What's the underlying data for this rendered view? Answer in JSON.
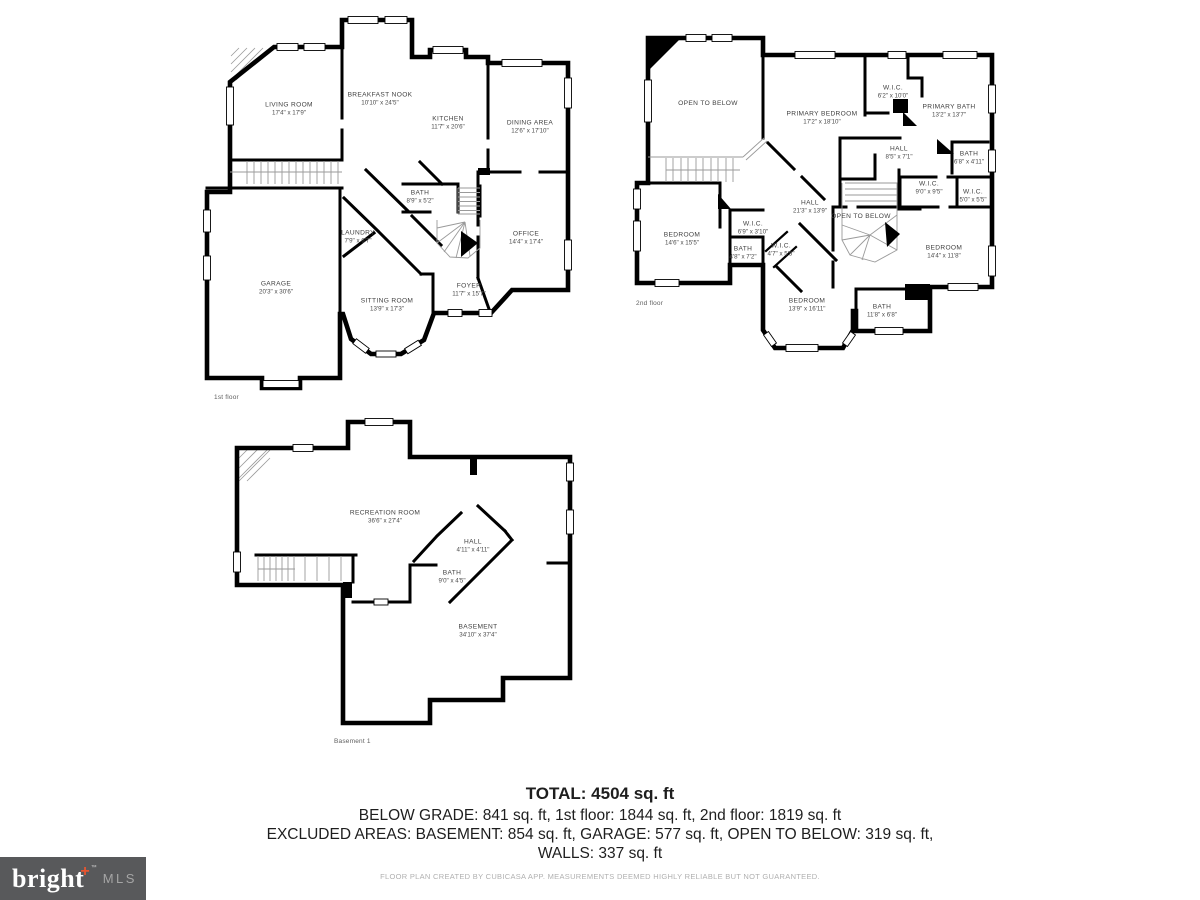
{
  "floors": {
    "first": {
      "caption": "1st floor",
      "rooms": [
        {
          "name": "LIVING ROOM",
          "dims": "17'4\" x 17'9\""
        },
        {
          "name": "BREAKFAST NOOK",
          "dims": "10'10\" x 24'5\""
        },
        {
          "name": "KITCHEN",
          "dims": "11'7\" x 20'6\""
        },
        {
          "name": "DINING AREA",
          "dims": "12'6\" x 17'10\""
        },
        {
          "name": "BATH",
          "dims": "8'9\" x 5'2\""
        },
        {
          "name": "OFFICE",
          "dims": "14'4\" x 17'4\""
        },
        {
          "name": "LAUNDRY",
          "dims": "7'9\" x 6'7\""
        },
        {
          "name": "GARAGE",
          "dims": "20'3\" x 30'6\""
        },
        {
          "name": "SITTING ROOM",
          "dims": "13'9\" x 17'3\""
        },
        {
          "name": "FOYER",
          "dims": "11'7\" x 15'7\""
        }
      ]
    },
    "second": {
      "caption": "2nd floor",
      "rooms": [
        {
          "name": "OPEN TO BELOW",
          "dims": ""
        },
        {
          "name": "PRIMARY BEDROOM",
          "dims": "17'2\" x 18'10\""
        },
        {
          "name": "W.I.C.",
          "dims": "6'2\" x 10'0\""
        },
        {
          "name": "PRIMARY BATH",
          "dims": "13'2\" x 13'7\""
        },
        {
          "name": "HALL",
          "dims": "8'5\" x 7'1\""
        },
        {
          "name": "BATH",
          "dims": "6'8\" x 4'11\""
        },
        {
          "name": "W.I.C.",
          "dims": "9'0\" x 9'5\""
        },
        {
          "name": "W.I.C.",
          "dims": "5'0\" x 5'5\""
        },
        {
          "name": "HALL",
          "dims": "21'3\" x 13'9\""
        },
        {
          "name": "OPEN TO BELOW",
          "dims": ""
        },
        {
          "name": "BEDROOM",
          "dims": "14'6\" x 15'5\""
        },
        {
          "name": "W.I.C.",
          "dims": "6'9\" x 3'10\""
        },
        {
          "name": "BATH",
          "dims": "4'8\" x 7'2\""
        },
        {
          "name": "W.I.C.",
          "dims": "4'7\" x 5'5\""
        },
        {
          "name": "BEDROOM",
          "dims": "14'4\" x 11'8\""
        },
        {
          "name": "BEDROOM",
          "dims": "13'9\" x 16'11\""
        },
        {
          "name": "BATH",
          "dims": "11'8\" x 6'8\""
        }
      ]
    },
    "basement": {
      "caption": "Basement 1",
      "rooms": [
        {
          "name": "RECREATION ROOM",
          "dims": "36'6\" x 27'4\""
        },
        {
          "name": "HALL",
          "dims": "4'11\" x 4'11\""
        },
        {
          "name": "BATH",
          "dims": "9'0\" x 4'5\""
        },
        {
          "name": "BASEMENT",
          "dims": "34'10\" x 37'4\""
        }
      ]
    }
  },
  "summary": {
    "total": "TOTAL: 4504 sq. ft",
    "line2": "BELOW GRADE: 841 sq. ft, 1st floor: 1844 sq. ft, 2nd floor: 1819 sq. ft",
    "line3": "EXCLUDED AREAS: BASEMENT: 854 sq. ft, GARAGE: 577 sq. ft, OPEN TO BELOW: 319 sq. ft,",
    "line4": "WALLS: 337 sq. ft",
    "disclaimer": "FLOOR PLAN CREATED BY CUBICASA APP. MEASUREMENTS DEEMED HIGHLY RELIABLE BUT NOT GUARANTEED."
  },
  "logo": {
    "brand": "bright",
    "plus": "+",
    "tm": "™",
    "suffix": "MLS",
    "bg_color": "#58595b",
    "plus_color": "#e8552f"
  }
}
